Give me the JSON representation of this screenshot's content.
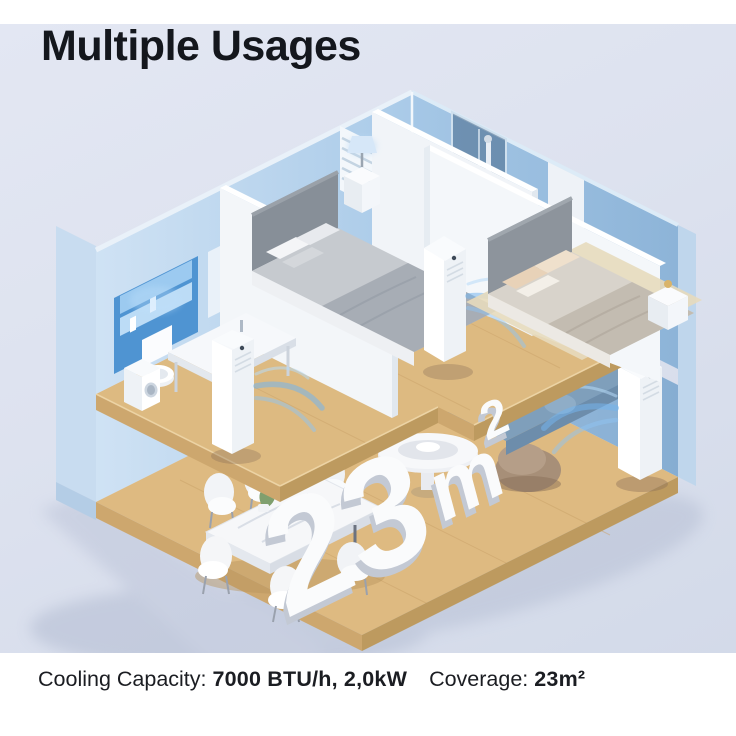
{
  "header": {
    "title": "Multiple Usages"
  },
  "floor_label": {
    "big": "23",
    "unit": "m",
    "sup": "2"
  },
  "footer": {
    "cooling_label": "Cooling Capacity: ",
    "cooling_value": "7000 BTU/h, 2,0kW",
    "coverage_label": "Coverage: ",
    "coverage_value": "23m²"
  },
  "palette": {
    "background": "#dde2ef",
    "wall_light_blue": "#c2dbf0",
    "wall_mid_blue": "#a2c5e4",
    "wall_dark_blue": "#8fb6da",
    "wall_section": "#c8dcf0",
    "wood_top": "#ddba81",
    "wood_edge": "#c9a46b",
    "partition_white": "#f4f7fa",
    "sofa_blue": "#7f9fbb",
    "beanbag_taupe": "#a18a73",
    "airflow_blue": "#74b4ec",
    "label_white": "#fafbfc",
    "text_dark": "#16181d"
  }
}
